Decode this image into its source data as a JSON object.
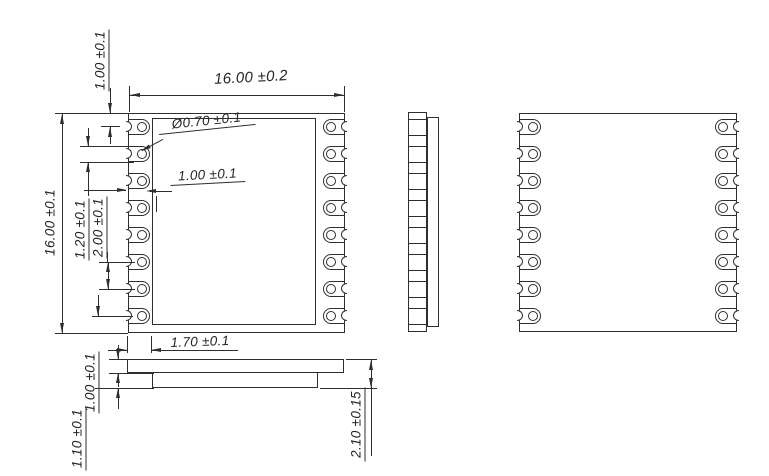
{
  "palette": {
    "background": "#ffffff",
    "line_color": "#2e2e2e",
    "text_color": "#262626"
  },
  "views": {
    "front": {
      "pads_per_side": 8
    },
    "back": {
      "pads_per_side": 8
    }
  },
  "dims": {
    "overall_width": "16.00 ±0.2",
    "overall_height": "16.00 ±0.1",
    "pad_top_offset": "1.00 ±0.1",
    "hole_diameter": "Ø0.70 ±0.1",
    "hole_edge_distance": "1.00 ±0.1",
    "pad_width": "1.20 ±0.1",
    "pad_pitch": "2.00 ±0.1",
    "shield_inset": "1.70 ±0.1",
    "pcb_thickness": "1.00 ±0.1",
    "shield_thickness": "1.10 ±0.1",
    "overall_thickness": "2.10 ±0.15"
  }
}
